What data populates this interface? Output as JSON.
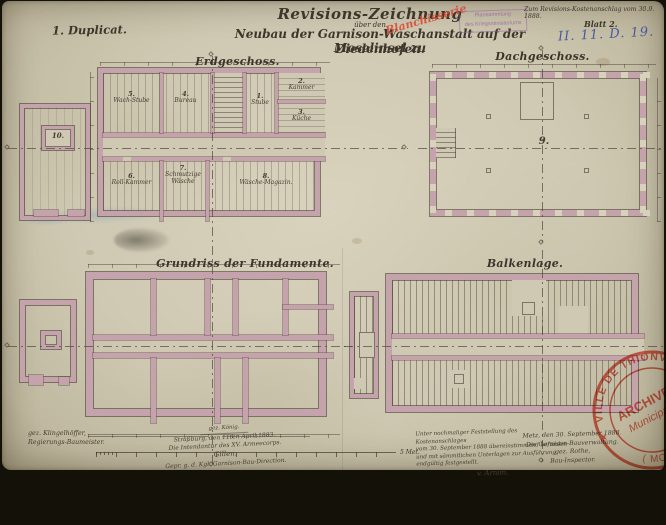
{
  "document": {
    "duplicate_note": "1. Duplicat.",
    "title": {
      "line1": "Revisions-Zeichnung",
      "line2": "über den",
      "line3": "Neubau der Garnison-Waschanstalt auf der Moselinsel zu",
      "line4": "Diedenhofen."
    },
    "red_annotation": "Blanchisserie",
    "ministry_stamp": {
      "line1": "Plansammlung",
      "line2": "des Kriegsministeriums"
    },
    "reference_note": "Zum Revisions-Kostenanschlag vom 30.9. 1888.",
    "sheet_label": "Blatt 2.",
    "registry_mark": "II. 11. D. 19."
  },
  "plans": {
    "erdgeschoss": {
      "label": "Erdgeschoss.",
      "rooms": {
        "wachstube": {
          "number": "5.",
          "name": "Wach-Stube"
        },
        "bureau": {
          "number": "4.",
          "name": "Bureau"
        },
        "stube": {
          "number": "1.",
          "name": "Stube"
        },
        "kammer": {
          "number": "2.",
          "name": "Kammer"
        },
        "kueche": {
          "number": "3.",
          "name": "Küche"
        },
        "rollkammer": {
          "number": "6.",
          "name": "Roll-Kammer"
        },
        "schmutzige": {
          "number": "7.",
          "name": "Schmutzige Wäsche"
        },
        "magazin": {
          "number": "8.",
          "name": "Wäsche-Magazin."
        },
        "annex_court": {
          "number": "10."
        }
      }
    },
    "dachgeschoss": {
      "label": "Dachgeschoss.",
      "room_number": "9."
    },
    "fundamente": {
      "label": "Grundriss der Fundamente."
    },
    "balkenlage": {
      "label": "Balkenlage."
    }
  },
  "scale_bar": {
    "end_label": "5 Met."
  },
  "colophon_left": {
    "gez_name": "gez. Klingelhöffer,",
    "gez_title": "Regierungs-Baumeister.",
    "small_note": "gez. König.",
    "place_date": "Straßburg, den 11ten April 1883.",
    "office": "Die Intendantur des XV. Armeecorps.",
    "signature": "Gillen.",
    "addendum": "Gepr. g. d. Kgl. Garnison-Bau-Direction."
  },
  "colophon_right": {
    "note_line1": "Unter nochmaliger Feststellung des Kostenanschlages",
    "note_line2": "vom 30. September 1888 übereinstimmend befunden",
    "note_line3": "und mit sämmtlichen Unterlagen zur Ausführung",
    "note_line4": "endgültig festgestellt.",
    "note_signature": "v. Arnim.",
    "place_date": "Metz, den 30. September 1888.",
    "office": "Die Garnison-Bauverwaltung.",
    "gez_name": "gez. Rothe,",
    "title": "Bau-Inspector."
  },
  "archive_stamp": {
    "arc_top": "VILLE DE THIONVILLE",
    "center_line1": "ARCHIVES",
    "center_line2": "Municipales",
    "arc_bottom": "( MOSELLE )",
    "star": "★"
  }
}
